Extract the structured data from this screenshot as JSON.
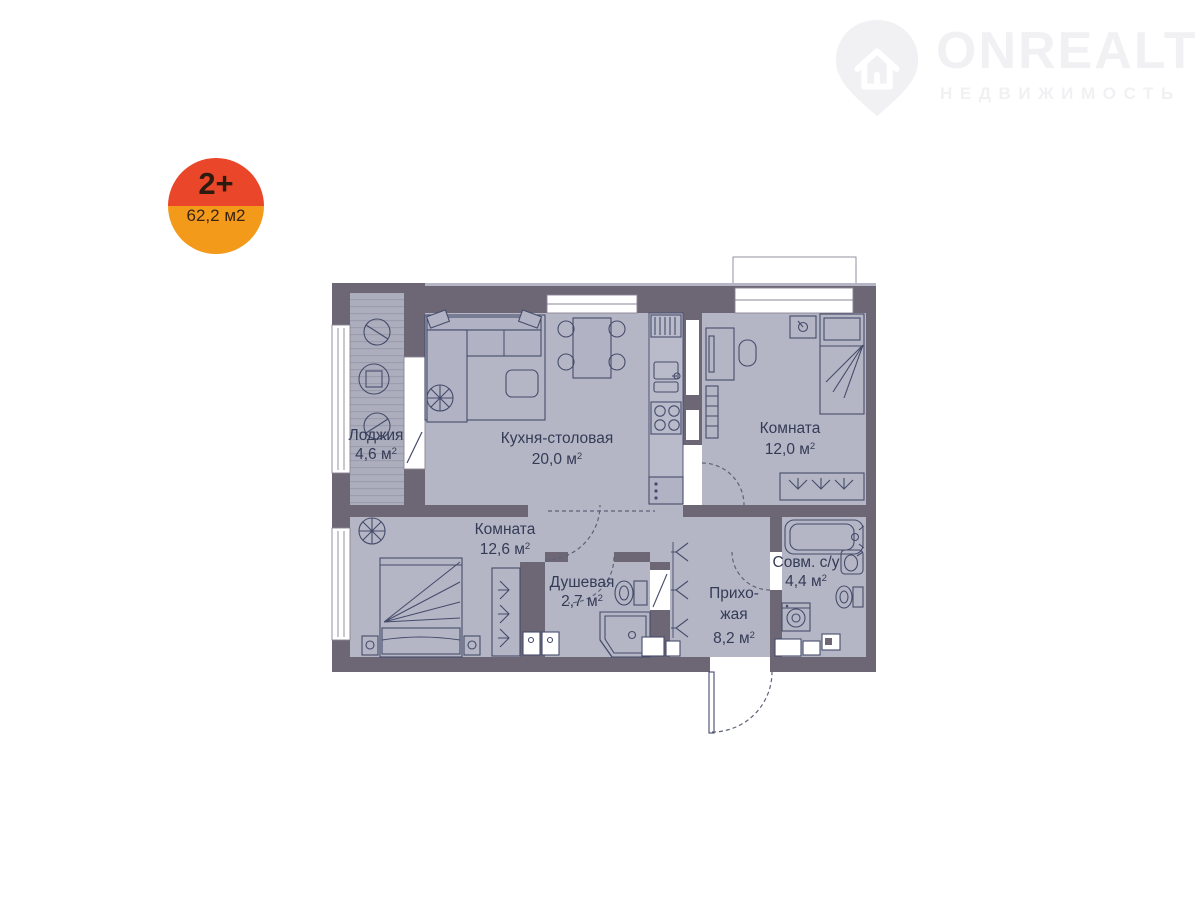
{
  "logo": {
    "brand": "ONREALT",
    "tagline": "НЕДВИЖИМОСТЬ",
    "color": "#f1f1f4"
  },
  "badge": {
    "rooms_label": "2+",
    "area_label": "62,2 м2",
    "top_color": "#ea4629",
    "bottom_color": "#f49a1b"
  },
  "plan": {
    "rooms": [
      {
        "id": "loggia",
        "name": "Лоджия",
        "area": "4,6 м",
        "sup": "2"
      },
      {
        "id": "kitchen",
        "name": "Кухня-столовая",
        "area": "20,0 м",
        "sup": "2"
      },
      {
        "id": "bedroom-right",
        "name": "Комната",
        "area": "12,0 м",
        "sup": "2"
      },
      {
        "id": "bedroom-left",
        "name": "Комната",
        "area": "12,6 м",
        "sup": "2"
      },
      {
        "id": "shower",
        "name": "Душевая",
        "area": "2,7 м",
        "sup": "2"
      },
      {
        "id": "bathroom",
        "name": "Совм. с/у",
        "area": "4,4 м",
        "sup": "2"
      },
      {
        "id": "hallway",
        "name_line1": "Прихо-",
        "name_line2": "жая",
        "area": "8,2 м",
        "sup": "2"
      }
    ],
    "colors": {
      "wall": "#6d6675",
      "floor": "#b5b6c5",
      "furniture_outline": "#454c6b",
      "label_text": "#343b56"
    }
  }
}
